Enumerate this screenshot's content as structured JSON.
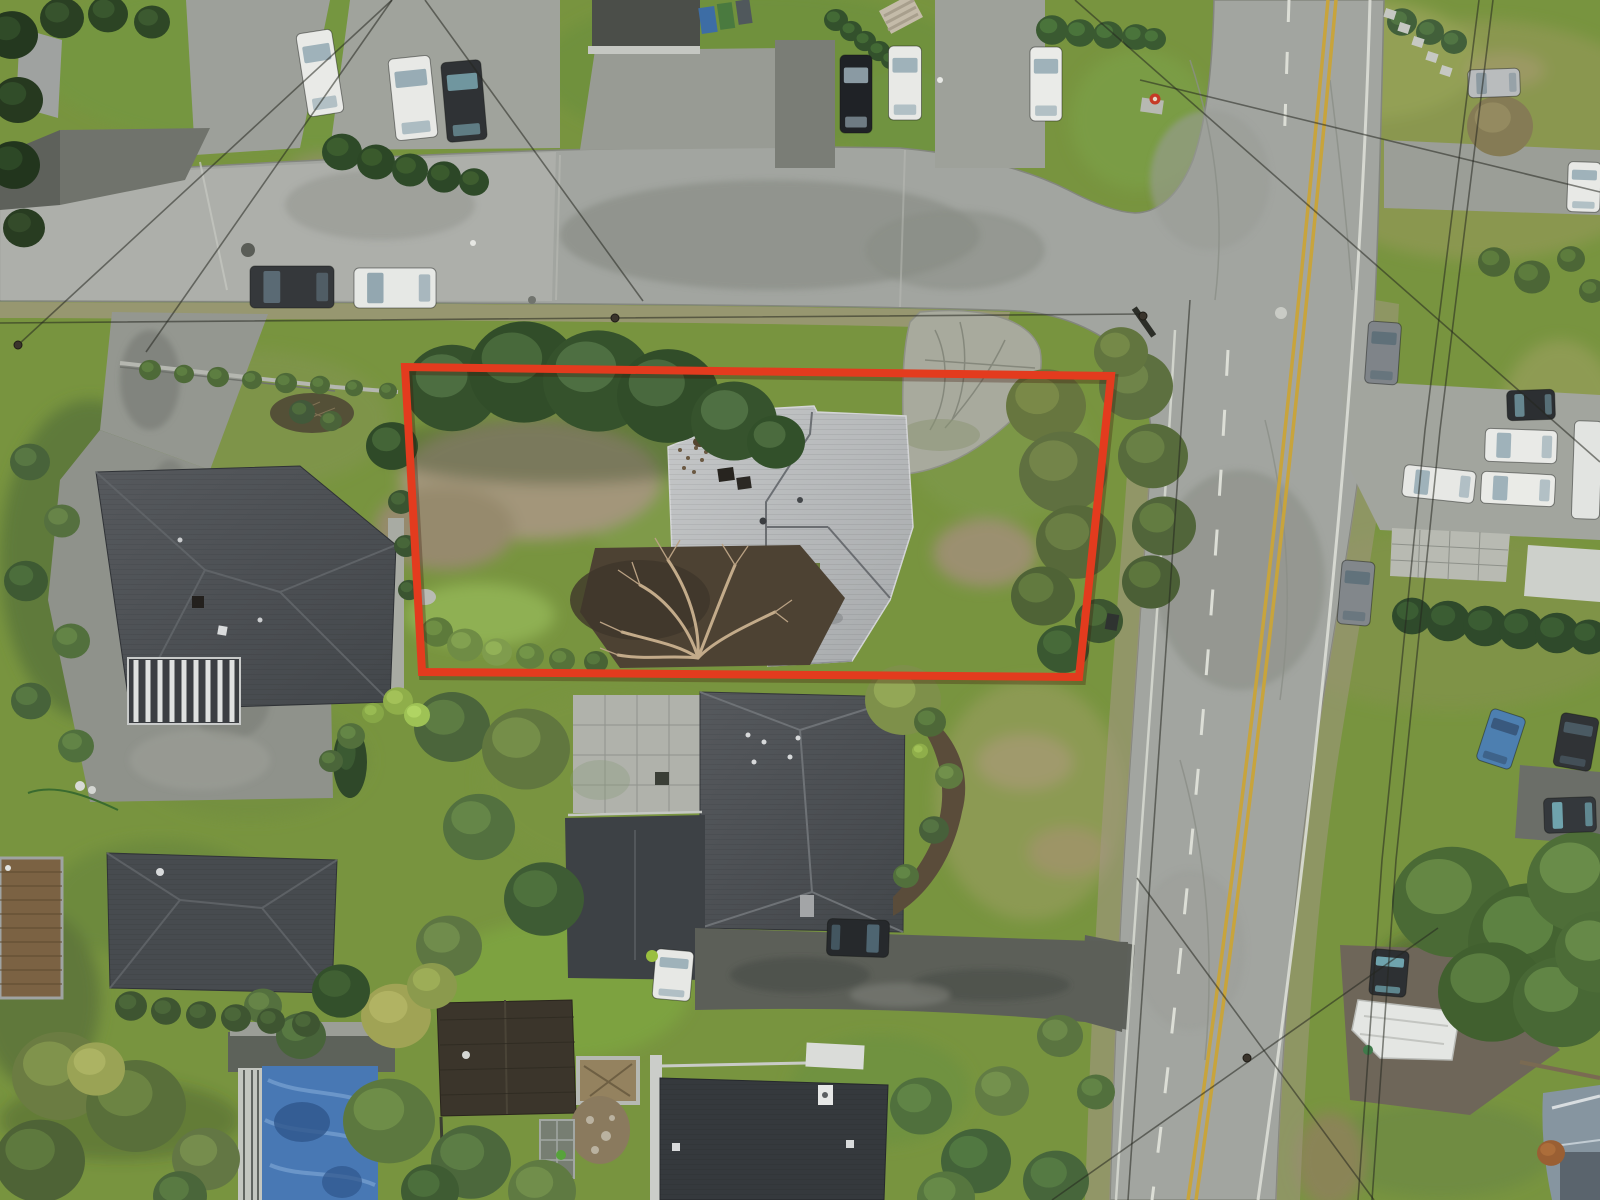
{
  "scene": {
    "kind": "aerial-drone-photo",
    "subject": "residential-lot-with-boundary-highlight"
  },
  "colors": {
    "boundary-red": "#e33b1e",
    "lane-yellow": "#c8a43c",
    "marking-white": "#dcded6",
    "asphalt": "#a2a5a0",
    "concrete": "#b3b5b0",
    "gravel": "#a19882",
    "grass-base": "#78943f",
    "grass-bright": "#8fb052",
    "grass-dead": "#a3967a",
    "roof-dark": "#45494d",
    "roof-darker": "#35393d",
    "roof-light": "#b8babc",
    "mulch": "#4d4233",
    "pool-blue": "#4878b4",
    "pool-blue-light": "#7aa3d2",
    "wire": "#24271f",
    "wood": "#7b6243"
  },
  "property_outline": {
    "points": [
      [
        405,
        367
      ],
      [
        1111,
        376
      ],
      [
        1079,
        677
      ],
      [
        422,
        672
      ]
    ],
    "stroke_width": 8
  },
  "trees": [
    [
      12,
      35,
      26,
      "#24381f",
      "#33502b"
    ],
    [
      18,
      100,
      25,
      "#26391f",
      "#35522c"
    ],
    [
      14,
      165,
      26,
      "#22351d",
      "#314d29"
    ],
    [
      24,
      228,
      21,
      "#283c21",
      "#374f2d"
    ],
    [
      62,
      18,
      22,
      "#2a4023",
      "#3b5830"
    ],
    [
      108,
      14,
      20,
      "#2c4424",
      "#3d5c31"
    ],
    [
      152,
      22,
      18,
      "#2e4726",
      "#405f33"
    ],
    [
      342,
      152,
      20,
      "#2e4a28",
      "#40622f"
    ],
    [
      376,
      162,
      19,
      "#2c4726",
      "#3e5f2e"
    ],
    [
      410,
      170,
      18,
      "#2e4a28",
      "#416230"
    ],
    [
      444,
      177,
      17,
      "#2c4727",
      "#3f5f2f"
    ],
    [
      474,
      182,
      15,
      "#2e4a28",
      "#426231"
    ],
    [
      836,
      20,
      12,
      "#33512c",
      "#477038"
    ],
    [
      851,
      31,
      11,
      "#33512c",
      "#477038"
    ],
    [
      865,
      41,
      11,
      "#33512c",
      "#477038"
    ],
    [
      879,
      51,
      11,
      "#33512c",
      "#477038"
    ],
    [
      891,
      60,
      10,
      "#33512c",
      "#477038"
    ],
    [
      1052,
      30,
      16,
      "#3a5a31",
      "#4f7a3e"
    ],
    [
      1080,
      33,
      15,
      "#3a5a31",
      "#4f7a3e"
    ],
    [
      1108,
      35,
      15,
      "#3a5a31",
      "#4f7a3e"
    ],
    [
      1136,
      37,
      14,
      "#3a5a31",
      "#4f7a3e"
    ],
    [
      1154,
      39,
      12,
      "#3a5a31",
      "#4f7a3e"
    ],
    [
      1500,
      126,
      33,
      "#857b55",
      "#978e63"
    ],
    [
      1494,
      262,
      16,
      "#4c6636",
      "#618240"
    ],
    [
      1532,
      277,
      18,
      "#4c6636",
      "#618240"
    ],
    [
      1571,
      259,
      14,
      "#4c6636",
      "#618240"
    ],
    [
      1592,
      291,
      13,
      "#4c6636",
      "#618240"
    ],
    [
      1402,
      22,
      15,
      "#42603a",
      "#557a46"
    ],
    [
      1430,
      32,
      14,
      "#42603a",
      "#557a46"
    ],
    [
      1454,
      42,
      13,
      "#42603a",
      "#557a46"
    ],
    [
      1412,
      616,
      20,
      "#2f4a2b",
      "#3f6136"
    ],
    [
      1448,
      621,
      22,
      "#2f4a2b",
      "#3f6136"
    ],
    [
      1485,
      626,
      22,
      "#2f4a2b",
      "#3f6136"
    ],
    [
      1521,
      629,
      22,
      "#2f4a2b",
      "#3f6136"
    ],
    [
      1557,
      633,
      22,
      "#2f4a2b",
      "#3f6136"
    ],
    [
      1589,
      637,
      19,
      "#2f4a2b",
      "#3f6136"
    ],
    [
      1452,
      902,
      60,
      "#4a6a35",
      "#6b8f49"
    ],
    [
      1532,
      942,
      64,
      "#446331",
      "#648a47"
    ],
    [
      1582,
      882,
      55,
      "#4e6e38",
      "#70944d"
    ],
    [
      1492,
      992,
      54,
      "#41602f",
      "#608545"
    ],
    [
      1562,
      1002,
      49,
      "#486835",
      "#688c4a"
    ],
    [
      1599,
      952,
      44,
      "#4c6c37",
      "#6d914c"
    ],
    [
      452,
      388,
      47,
      "#35512c",
      "#547547"
    ],
    [
      524,
      372,
      55,
      "#314d29",
      "#4f7040"
    ],
    [
      598,
      381,
      55,
      "#35522c",
      "#557748"
    ],
    [
      668,
      396,
      51,
      "#314d29",
      "#507143"
    ],
    [
      734,
      421,
      43,
      "#36532d",
      "#567849"
    ],
    [
      776,
      442,
      29,
      "#32502a",
      "#517244"
    ],
    [
      392,
      446,
      26,
      "#2f4a28",
      "#4a6b3b"
    ],
    [
      1046,
      406,
      40,
      "#67763f",
      "#7f8f4b"
    ],
    [
      1063,
      472,
      44,
      "#5f7040",
      "#78894b"
    ],
    [
      1076,
      542,
      40,
      "#57693a",
      "#6f8347"
    ],
    [
      1043,
      596,
      32,
      "#4f6336",
      "#678042"
    ],
    [
      1099,
      621,
      24,
      "#3c5530",
      "#50703c"
    ],
    [
      1136,
      386,
      37,
      "#5d7040",
      "#748a4b"
    ],
    [
      1153,
      456,
      35,
      "#576b3c",
      "#6e8647"
    ],
    [
      1164,
      526,
      32,
      "#51653a",
      "#688243"
    ],
    [
      1151,
      582,
      29,
      "#4b5f36",
      "#627c40"
    ],
    [
      1121,
      352,
      27,
      "#62753f",
      "#7a8f4b"
    ],
    [
      1063,
      649,
      26,
      "#3a5831",
      "#4b6f3c"
    ],
    [
      903,
      700,
      38,
      "#7e904a",
      "#99ad59"
    ],
    [
      452,
      727,
      38,
      "#4b653b",
      "#628246"
    ],
    [
      526,
      749,
      44,
      "#61773f",
      "#7b934c"
    ],
    [
      479,
      827,
      36,
      "#53713f",
      "#6a8c4b"
    ],
    [
      544,
      899,
      40,
      "#3e5c34",
      "#527740"
    ],
    [
      449,
      946,
      33,
      "#5d7642",
      "#75924f"
    ],
    [
      350,
      762,
      17,
      "#2f4829",
      "#3f5f35",
      36
    ],
    [
      398,
      701,
      15,
      "#8fae4a",
      "#a7c65b"
    ],
    [
      417,
      715,
      13,
      "#9ec255",
      "#b4d866"
    ],
    [
      373,
      713,
      11,
      "#87a747",
      "#9cbf55"
    ],
    [
      401,
      502,
      13,
      "#3a5431",
      "#4b6a3c"
    ],
    [
      406,
      546,
      12,
      "#3a5431",
      "#4b6a3c"
    ],
    [
      409,
      590,
      11,
      "#3a5431",
      "#4b6a3c"
    ],
    [
      150,
      370,
      11,
      "#4e6a38",
      "#628343"
    ],
    [
      184,
      374,
      10,
      "#4e6a38",
      "#628343"
    ],
    [
      218,
      377,
      11,
      "#4e6a38",
      "#628343"
    ],
    [
      252,
      380,
      10,
      "#4e6a38",
      "#628343"
    ],
    [
      286,
      383,
      11,
      "#4e6a38",
      "#628343"
    ],
    [
      320,
      385,
      10,
      "#4e6a38",
      "#628343"
    ],
    [
      354,
      388,
      9,
      "#4e6a38",
      "#628343"
    ],
    [
      388,
      391,
      9,
      "#4e6a38",
      "#628343"
    ],
    [
      30,
      462,
      20,
      "#48633a",
      "#5c7c46"
    ],
    [
      62,
      521,
      18,
      "#55703f",
      "#6b8a4b"
    ],
    [
      26,
      581,
      22,
      "#3e5a33",
      "#50733f"
    ],
    [
      71,
      641,
      19,
      "#52703d",
      "#688a49"
    ],
    [
      31,
      701,
      20,
      "#47633a",
      "#5b7d45"
    ],
    [
      76,
      746,
      18,
      "#50703d",
      "#668a49"
    ],
    [
      302,
      412,
      13,
      "#42593a",
      "#53703f"
    ],
    [
      331,
      421,
      11,
      "#4a6339",
      "#5f7e44"
    ],
    [
      351,
      736,
      14,
      "#53703c",
      "#698c48"
    ],
    [
      331,
      761,
      12,
      "#4b663a",
      "#5f8145"
    ],
    [
      60,
      1076,
      48,
      "#6b7c42",
      "#86984f"
    ],
    [
      136,
      1106,
      50,
      "#596f3a",
      "#708a46"
    ],
    [
      40,
      1161,
      45,
      "#4e6336",
      "#637e41"
    ],
    [
      96,
      1069,
      29,
      "#9aa355",
      "#b0b766"
    ],
    [
      206,
      1159,
      34,
      "#637744",
      "#7b9250"
    ],
    [
      389,
      1121,
      46,
      "#5c783f",
      "#73924b"
    ],
    [
      301,
      1036,
      25,
      "#48643a",
      "#5c7e45"
    ],
    [
      263,
      1006,
      19,
      "#54703e",
      "#6a8a4a"
    ],
    [
      131,
      1006,
      16,
      "#3e5531",
      "#4f6b3c"
    ],
    [
      166,
      1011,
      15,
      "#3e5531",
      "#4f6b3c"
    ],
    [
      201,
      1015,
      15,
      "#3e5531",
      "#4f6b3c"
    ],
    [
      236,
      1018,
      15,
      "#3e5531",
      "#4f6b3c"
    ],
    [
      271,
      1021,
      14,
      "#3e5531",
      "#4f6b3c"
    ],
    [
      306,
      1024,
      14,
      "#3e5531",
      "#4f6b3c"
    ],
    [
      396,
      1016,
      35,
      "#a0a355",
      "#b5b766"
    ],
    [
      432,
      986,
      25,
      "#8b9a4d",
      "#a1b15a"
    ],
    [
      341,
      991,
      29,
      "#33502b",
      "#446436"
    ],
    [
      471,
      1162,
      40,
      "#4c683c",
      "#608247"
    ],
    [
      542,
      1191,
      34,
      "#5f7a42",
      "#76944e"
    ],
    [
      430,
      1191,
      29,
      "#3f5c33",
      "#50743e"
    ],
    [
      180,
      1196,
      27,
      "#4a663a",
      "#5d8045"
    ],
    [
      921,
      1106,
      31,
      "#50703d",
      "#648a48"
    ],
    [
      976,
      1161,
      35,
      "#436339",
      "#557d44"
    ],
    [
      946,
      1198,
      29,
      "#56763f",
      "#6c904b"
    ],
    [
      1002,
      1091,
      27,
      "#627c44",
      "#799650"
    ],
    [
      1056,
      1181,
      33,
      "#47663b",
      "#598046"
    ],
    [
      1060,
      1036,
      23,
      "#5a7440",
      "#708e4c"
    ],
    [
      1096,
      1092,
      19,
      "#52703d",
      "#668a48"
    ],
    [
      437,
      632,
      16,
      "#5d7a3b",
      "#739447"
    ],
    [
      465,
      645,
      18,
      "#6f8c45",
      "#87a652"
    ],
    [
      497,
      652,
      15,
      "#7f9c4d",
      "#97b65a"
    ],
    [
      530,
      656,
      14,
      "#62803f",
      "#789a4b"
    ],
    [
      562,
      660,
      13,
      "#557239",
      "#6a8c45"
    ],
    [
      596,
      662,
      12,
      "#486334",
      "#5a7c40"
    ],
    [
      1551,
      1153,
      14,
      "#9a5f33",
      "#b0713c"
    ],
    [
      930,
      722,
      16,
      "#4e6838",
      "#628344"
    ],
    [
      949,
      776,
      14,
      "#5f7a40",
      "#75964d"
    ],
    [
      934,
      830,
      15,
      "#47603a",
      "#597946"
    ],
    [
      906,
      876,
      13,
      "#52703c",
      "#678c49"
    ],
    [
      920,
      751,
      8,
      "#8fae4a",
      "#a5c65a"
    ]
  ],
  "vehicles": [
    [
      "car-white-1",
      320,
      73,
      84,
      36,
      -99,
      "#e9eae7",
      "#9fb2ba"
    ],
    [
      "van-white-1",
      413,
      98,
      82,
      42,
      -96,
      "#e8e9e6",
      "#98acb5"
    ],
    [
      "suv-dark-1",
      464,
      101,
      80,
      40,
      -95,
      "#2f3235",
      "#70969f"
    ],
    [
      "sedan-black-1",
      856,
      94,
      78,
      32,
      -90,
      "#1f2226",
      "#8a9aa3"
    ],
    [
      "sedan-white-2",
      905,
      83,
      74,
      33,
      -90,
      "#e8e9e6",
      "#9fb2ba"
    ],
    [
      "car-white-3",
      1046,
      84,
      74,
      32,
      -90,
      "#eaebe8",
      "#9fb2ba"
    ],
    [
      "pickup-dark-street",
      292,
      287,
      84,
      42,
      180,
      "#35383b",
      "#5a6a74"
    ],
    [
      "car-white-street",
      395,
      288,
      82,
      40,
      180,
      "#e6e8e5",
      "#93a7b0"
    ],
    [
      "car-gray-road-1",
      1383,
      353,
      62,
      33,
      -86,
      "#7f8489",
      "#5f7079"
    ],
    [
      "suv-dark-east",
      1531,
      405,
      48,
      30,
      178,
      "#2c2f32",
      "#66868f"
    ],
    [
      "sedan-white-east-1",
      1521,
      446,
      72,
      33,
      182,
      "#e9eae7",
      "#9fb2ba"
    ],
    [
      "car-white-east-2",
      1439,
      484,
      72,
      32,
      186,
      "#e7e8e5",
      "#9fb2ba"
    ],
    [
      "car-white-east-3",
      1518,
      489,
      74,
      32,
      183,
      "#eaebe7",
      "#9fb2ba"
    ],
    [
      "trailer-white-east",
      1587,
      470,
      98,
      28,
      -88,
      "#e2e4e1",
      null
    ],
    [
      "car-gray-road-2",
      1356,
      593,
      64,
      33,
      -85,
      "#82878b",
      "#61727b"
    ],
    [
      "car-blue-se",
      1501,
      739,
      54,
      36,
      -72,
      "#4d7fb0",
      "#39597e"
    ],
    [
      "car-dark-se",
      1576,
      742,
      54,
      38,
      -80,
      "#303336",
      "#4a5a63"
    ],
    [
      "minivan-dark-se",
      1570,
      815,
      52,
      35,
      178,
      "#34383c",
      "#6fa3ad"
    ],
    [
      "suv-black-driveway",
      858,
      938,
      62,
      37,
      2,
      "#26292c",
      "#4e6571"
    ],
    [
      "van-white-south",
      673,
      975,
      50,
      38,
      -85,
      "#e7e8e5",
      "#9fb2ba"
    ],
    [
      "car-dark-gravel",
      1389,
      973,
      46,
      37,
      -85,
      "#2d3033",
      "#6fa3ad"
    ],
    [
      "car-silver-ne",
      1494,
      83,
      52,
      28,
      178,
      "#b9bcbd",
      "#8c9aa1"
    ],
    [
      "car-white-ne",
      1584,
      187,
      50,
      33,
      -88,
      "#e8e9e6",
      "#9fb2ba"
    ]
  ],
  "wires": [
    [
      [
        392,
        0
      ],
      [
        146,
        352
      ]
    ],
    [
      [
        425,
        0
      ],
      [
        643,
        301
      ]
    ],
    [
      [
        0,
        323
      ],
      [
        615,
        318
      ],
      [
        1143,
        314
      ]
    ],
    [
      [
        1075,
        0
      ],
      [
        1600,
        462
      ]
    ],
    [
      [
        1140,
        80
      ],
      [
        1600,
        192
      ]
    ],
    [
      [
        1493,
        0
      ],
      [
        1440,
        430
      ],
      [
        1396,
        860
      ],
      [
        1372,
        1200
      ]
    ],
    [
      [
        1479,
        0
      ],
      [
        1425,
        430
      ],
      [
        1382,
        860
      ],
      [
        1358,
        1200
      ]
    ],
    [
      [
        1190,
        300
      ],
      [
        1128,
        1200
      ]
    ],
    [
      [
        1137,
        878
      ],
      [
        1374,
        1200
      ]
    ],
    [
      [
        1052,
        1200
      ],
      [
        1438,
        928
      ]
    ],
    [
      [
        18,
        345
      ],
      [
        392,
        0
      ]
    ]
  ],
  "poles": [
    [
      18,
      345
    ],
    [
      615,
      318
    ],
    [
      1143,
      316
    ],
    [
      1247,
      1058
    ]
  ],
  "props": [
    [
      "rect",
      "hydrant-pad",
      1152,
      106,
      22,
      14,
      "#b7b9b2",
      8
    ],
    [
      "circle",
      "fire-hydrant",
      1155,
      99,
      5.5,
      0,
      "#c63a26",
      0
    ],
    [
      "circle",
      "fire-hydrant-cap",
      1155,
      99,
      2.2,
      0,
      "#e8d8c8",
      0
    ],
    [
      "circle",
      "manhole-cover",
      248,
      250,
      7,
      0,
      "#5a5d57",
      0
    ],
    [
      "circle",
      "manhole-ring",
      1281,
      313,
      6,
      0,
      "#c9cbc5",
      0
    ],
    [
      "circle",
      "manhole-small",
      532,
      300,
      4,
      0,
      "#71746e",
      0
    ],
    [
      "rect",
      "bin-blue",
      708,
      20,
      16,
      26,
      "#3d6da5",
      -8
    ],
    [
      "rect",
      "bin-green",
      726,
      16,
      15,
      26,
      "#4a7a3f",
      -8
    ],
    [
      "rect",
      "bin-gray",
      744,
      12,
      14,
      24,
      "#50585c",
      -8
    ],
    [
      "rect",
      "log-pile",
      901,
      14,
      36,
      26,
      "#c4bba9",
      -28
    ],
    [
      "rect",
      "log-1",
      899,
      8,
      34,
      3,
      "#a89f8d",
      -28
    ],
    [
      "rect",
      "log-2",
      901,
      15,
      34,
      3,
      "#a89f8d",
      -28
    ],
    [
      "rect",
      "log-3",
      903,
      22,
      34,
      3,
      "#a89f8d",
      -28
    ],
    [
      "circle",
      "planter-white-1",
      80,
      786,
      5,
      0,
      "#d8dad6",
      0
    ],
    [
      "circle",
      "planter-white-2",
      92,
      790,
      4,
      0,
      "#d4d6d2",
      0
    ],
    [
      "rect",
      "mailbox",
      1112,
      622,
      12,
      16,
      "#2f3330",
      10
    ],
    [
      "circle",
      "trash-speck-1",
      940,
      80,
      3,
      0,
      "#e8e9e5",
      0
    ],
    [
      "circle",
      "trash-speck-2",
      473,
      243,
      3,
      0,
      "#e6e7e3",
      0
    ],
    [
      "circle",
      "bin-lime",
      652,
      956,
      6,
      0,
      "#9abf3f",
      0
    ],
    [
      "circle",
      "bin-green-2",
      561,
      1155,
      5,
      0,
      "#57a33b",
      0
    ],
    [
      "rect",
      "stepping-stone-1",
      1390,
      14,
      11,
      9,
      "#c6c8c2",
      18
    ],
    [
      "rect",
      "stepping-stone-2",
      1404,
      28,
      11,
      9,
      "#c6c8c2",
      18
    ],
    [
      "rect",
      "stepping-stone-3",
      1418,
      42,
      11,
      9,
      "#c6c8c2",
      18
    ],
    [
      "rect",
      "stepping-stone-4",
      1432,
      57,
      11,
      9,
      "#c6c8c2",
      18
    ],
    [
      "rect",
      "stepping-stone-5",
      1446,
      71,
      11,
      9,
      "#c6c8c2",
      18
    ],
    [
      "rect",
      "utility-pole-crossarm",
      1144,
      322,
      34,
      6,
      "#2c2e28",
      55
    ]
  ]
}
